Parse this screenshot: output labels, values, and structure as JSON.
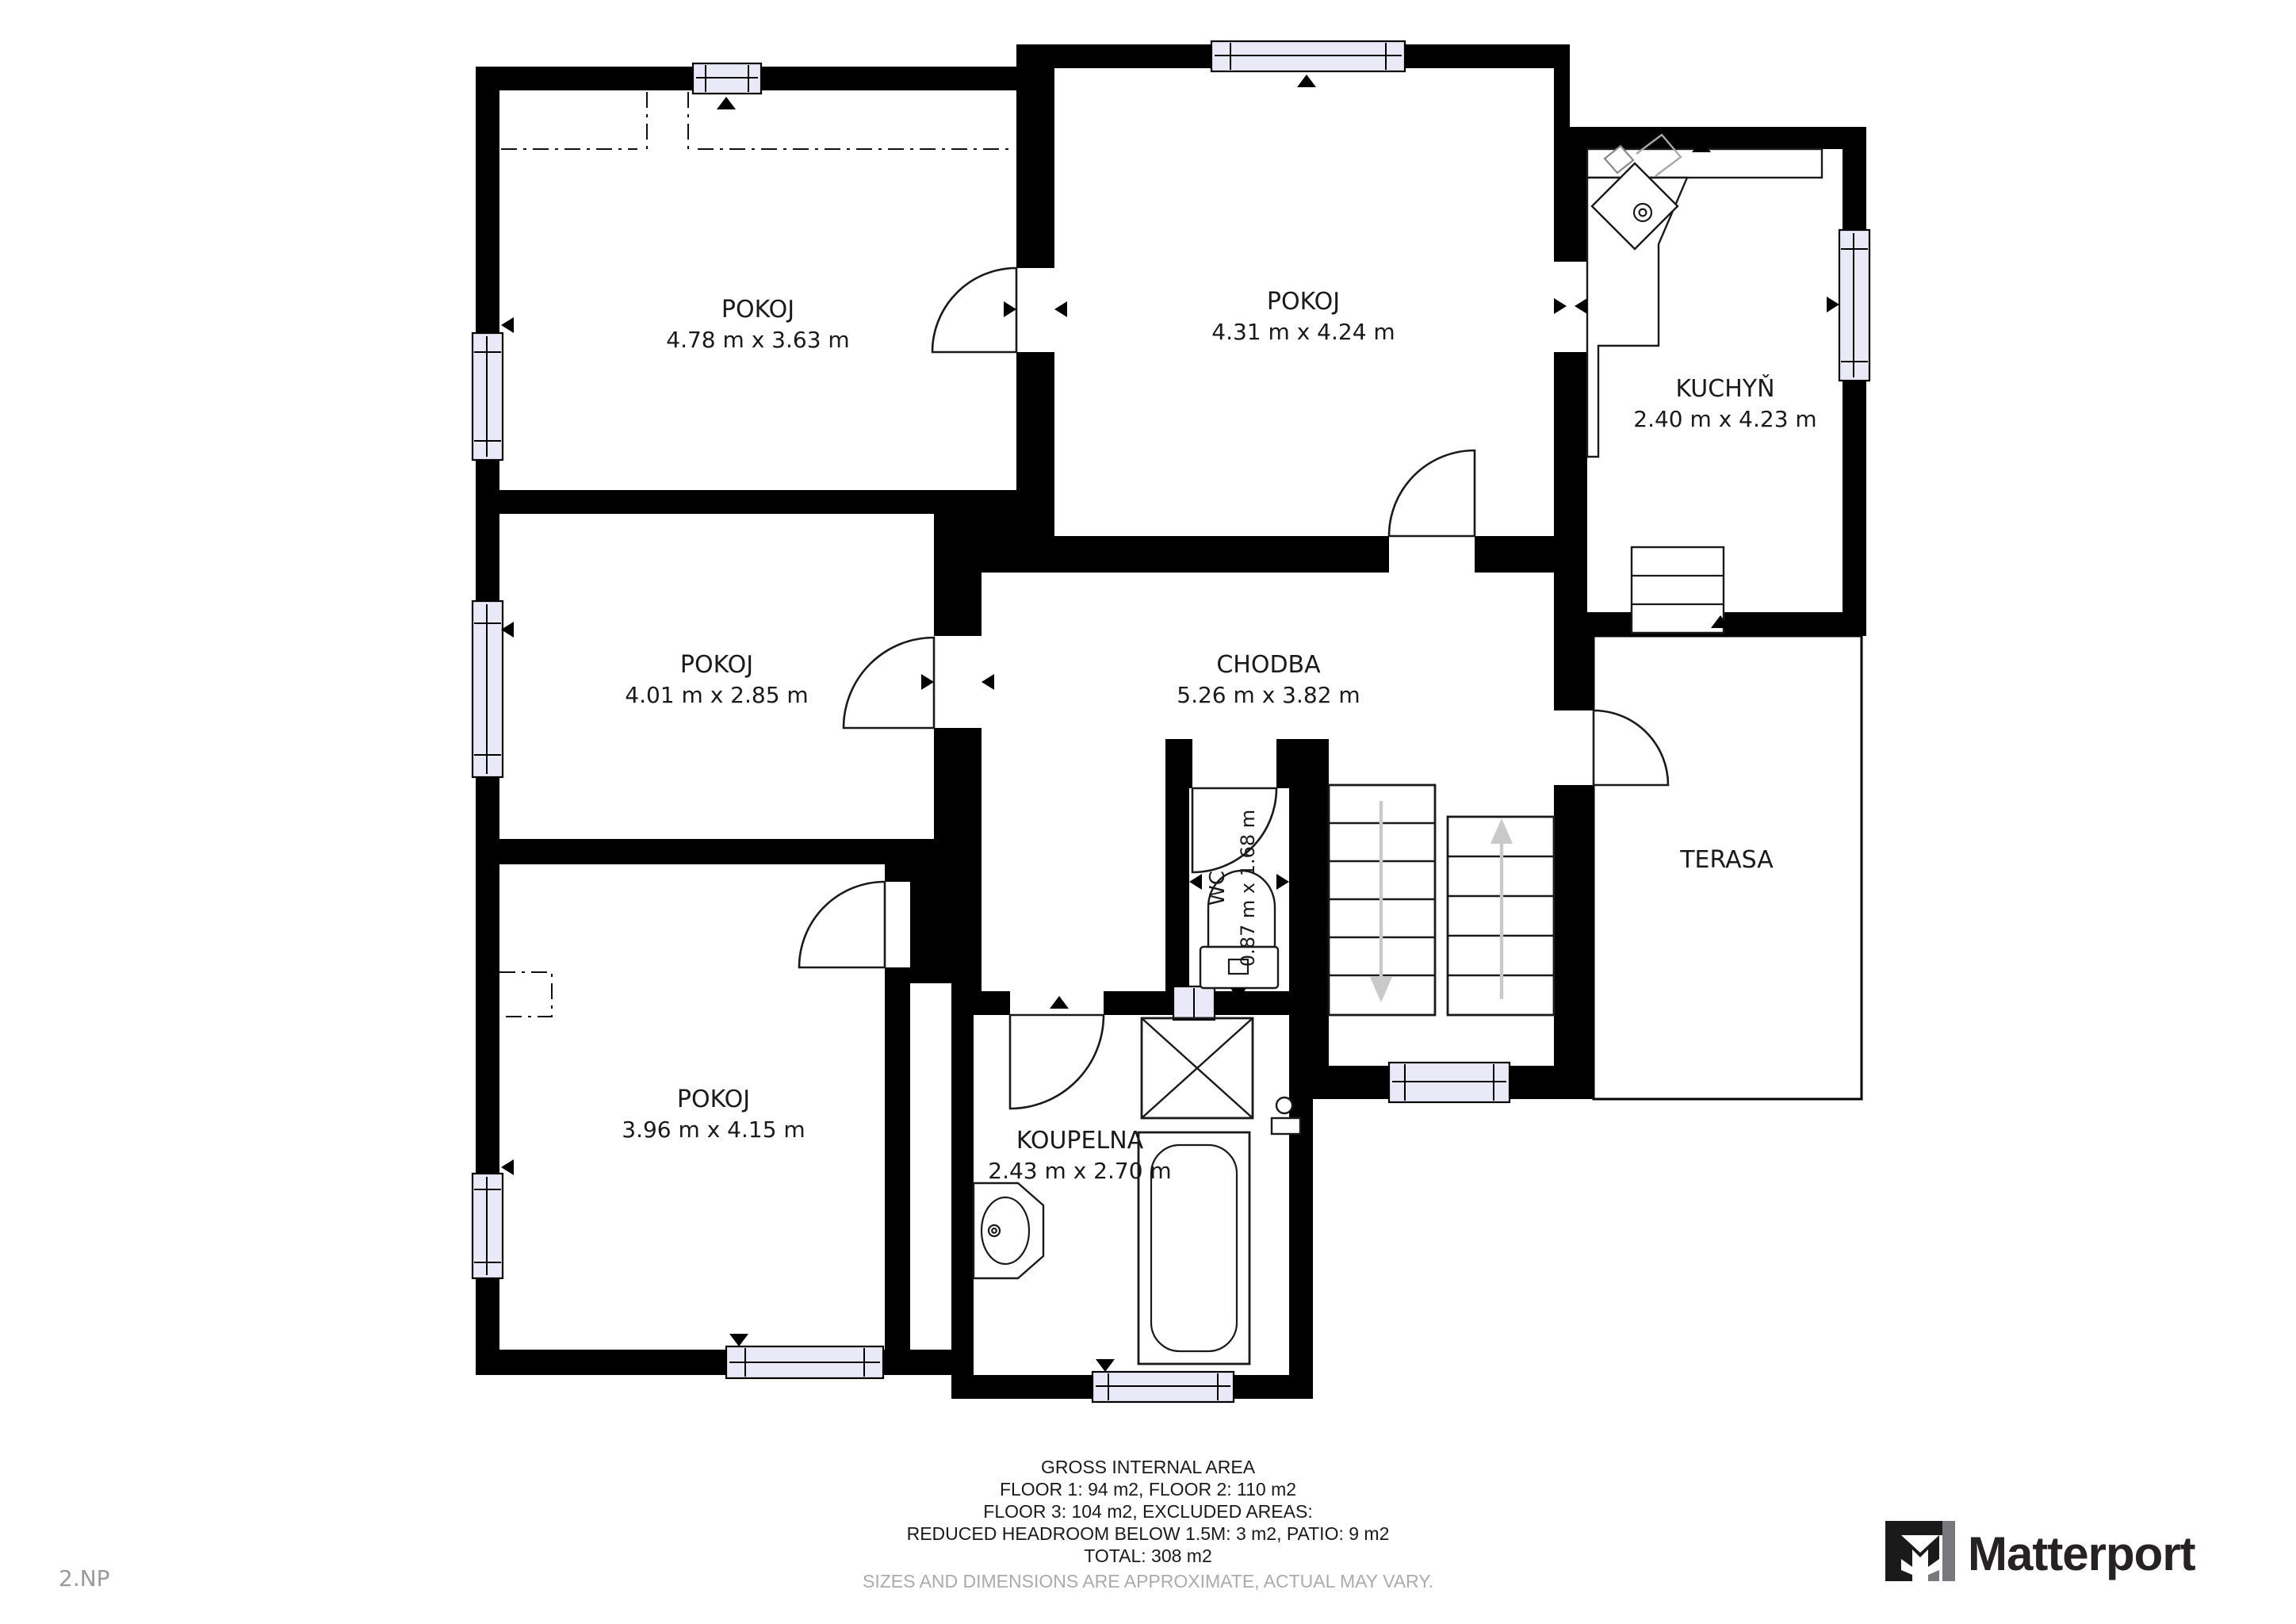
{
  "floor_label": "2.NP",
  "rooms": [
    {
      "id": "pokoj-top-left",
      "name": "POKOJ",
      "dims": "4.78 m x 3.63 m"
    },
    {
      "id": "pokoj-top-right",
      "name": "POKOJ",
      "dims": "4.31 m x 4.24 m"
    },
    {
      "id": "kuchyn",
      "name": "KUCHYŇ",
      "dims": "2.40 m x 4.23 m"
    },
    {
      "id": "pokoj-middle-left",
      "name": "POKOJ",
      "dims": "4.01 m x 2.85 m"
    },
    {
      "id": "chodba",
      "name": "CHODBA",
      "dims": "5.26 m x 3.82 m"
    },
    {
      "id": "wc",
      "name": "WC",
      "dims": "0.87 m x 1.68 m"
    },
    {
      "id": "pokoj-bottom-left",
      "name": "POKOJ",
      "dims": "3.96 m x 4.15 m"
    },
    {
      "id": "koupelna",
      "name": "KOUPELNA",
      "dims": "2.43 m x 2.70 m"
    },
    {
      "id": "terasa",
      "name": "TERASA",
      "dims": ""
    }
  ],
  "footer": {
    "line1": "GROSS INTERNAL AREA",
    "line2": "FLOOR 1: 94 m2, FLOOR 2: 110 m2",
    "line3": "FLOOR 3: 104 m2, EXCLUDED AREAS:",
    "line4": "REDUCED HEADROOM BELOW 1.5M: 3 m2, PATIO: 9 m2",
    "line5": "TOTAL: 308 m2",
    "disclaimer": "SIZES AND DIMENSIONS ARE APPROXIMATE, ACTUAL MAY VARY."
  },
  "brand": {
    "name": "Matterport"
  },
  "colors": {
    "wall": "#000000",
    "window_glass": "#E9E9F8",
    "stair_arrow": "#c9c9c9",
    "muted_text": "#9a9a9a"
  }
}
